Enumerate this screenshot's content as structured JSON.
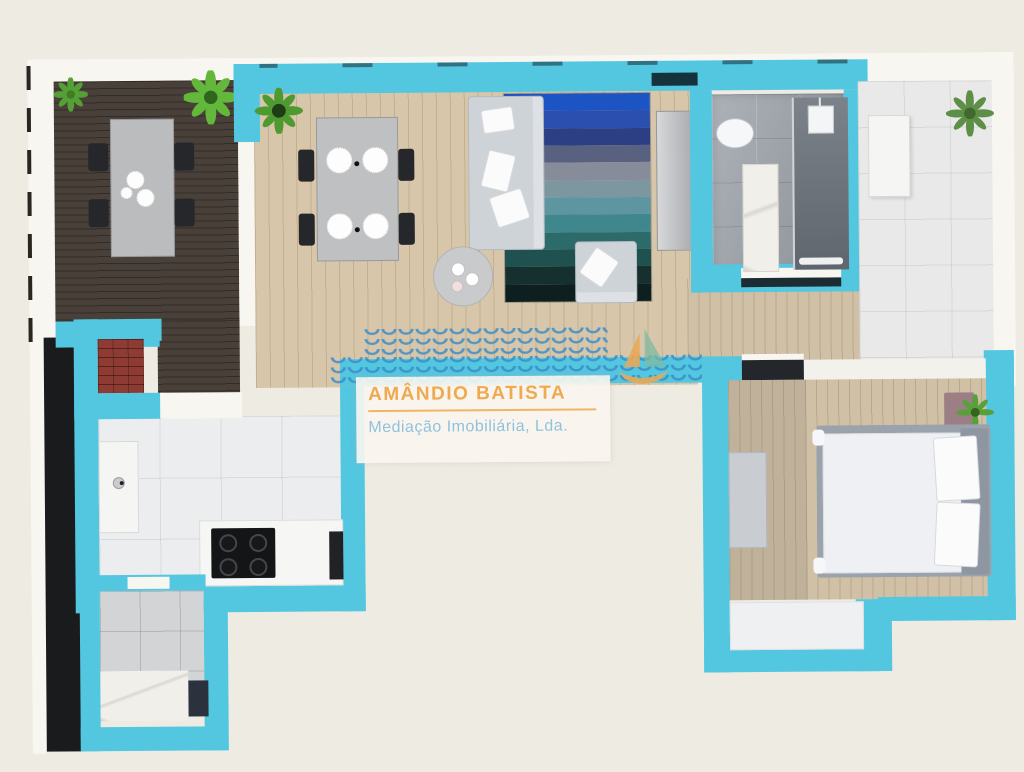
{
  "watermark": {
    "title": "AMÂNDIO BATISTA",
    "subtitle": "Mediação Imobiliária, Lda."
  },
  "palette": {
    "wall_cyan": "#53c6e0",
    "background_beige": "#eeebe2",
    "accent_orange": "#efa94f",
    "accent_light_blue": "#8fc2dc",
    "deck_wood": "#4a403a",
    "interior_wood": "#d7c6aa",
    "rug_stripes": [
      "#1c54c4",
      "#2a4fae",
      "#2c3f85",
      "#58617f",
      "#878c9a",
      "#7d97a1",
      "#5d96a0",
      "#3f878c",
      "#2c6b6a",
      "#1e514f",
      "#15302e",
      "#0d1f1e"
    ]
  }
}
